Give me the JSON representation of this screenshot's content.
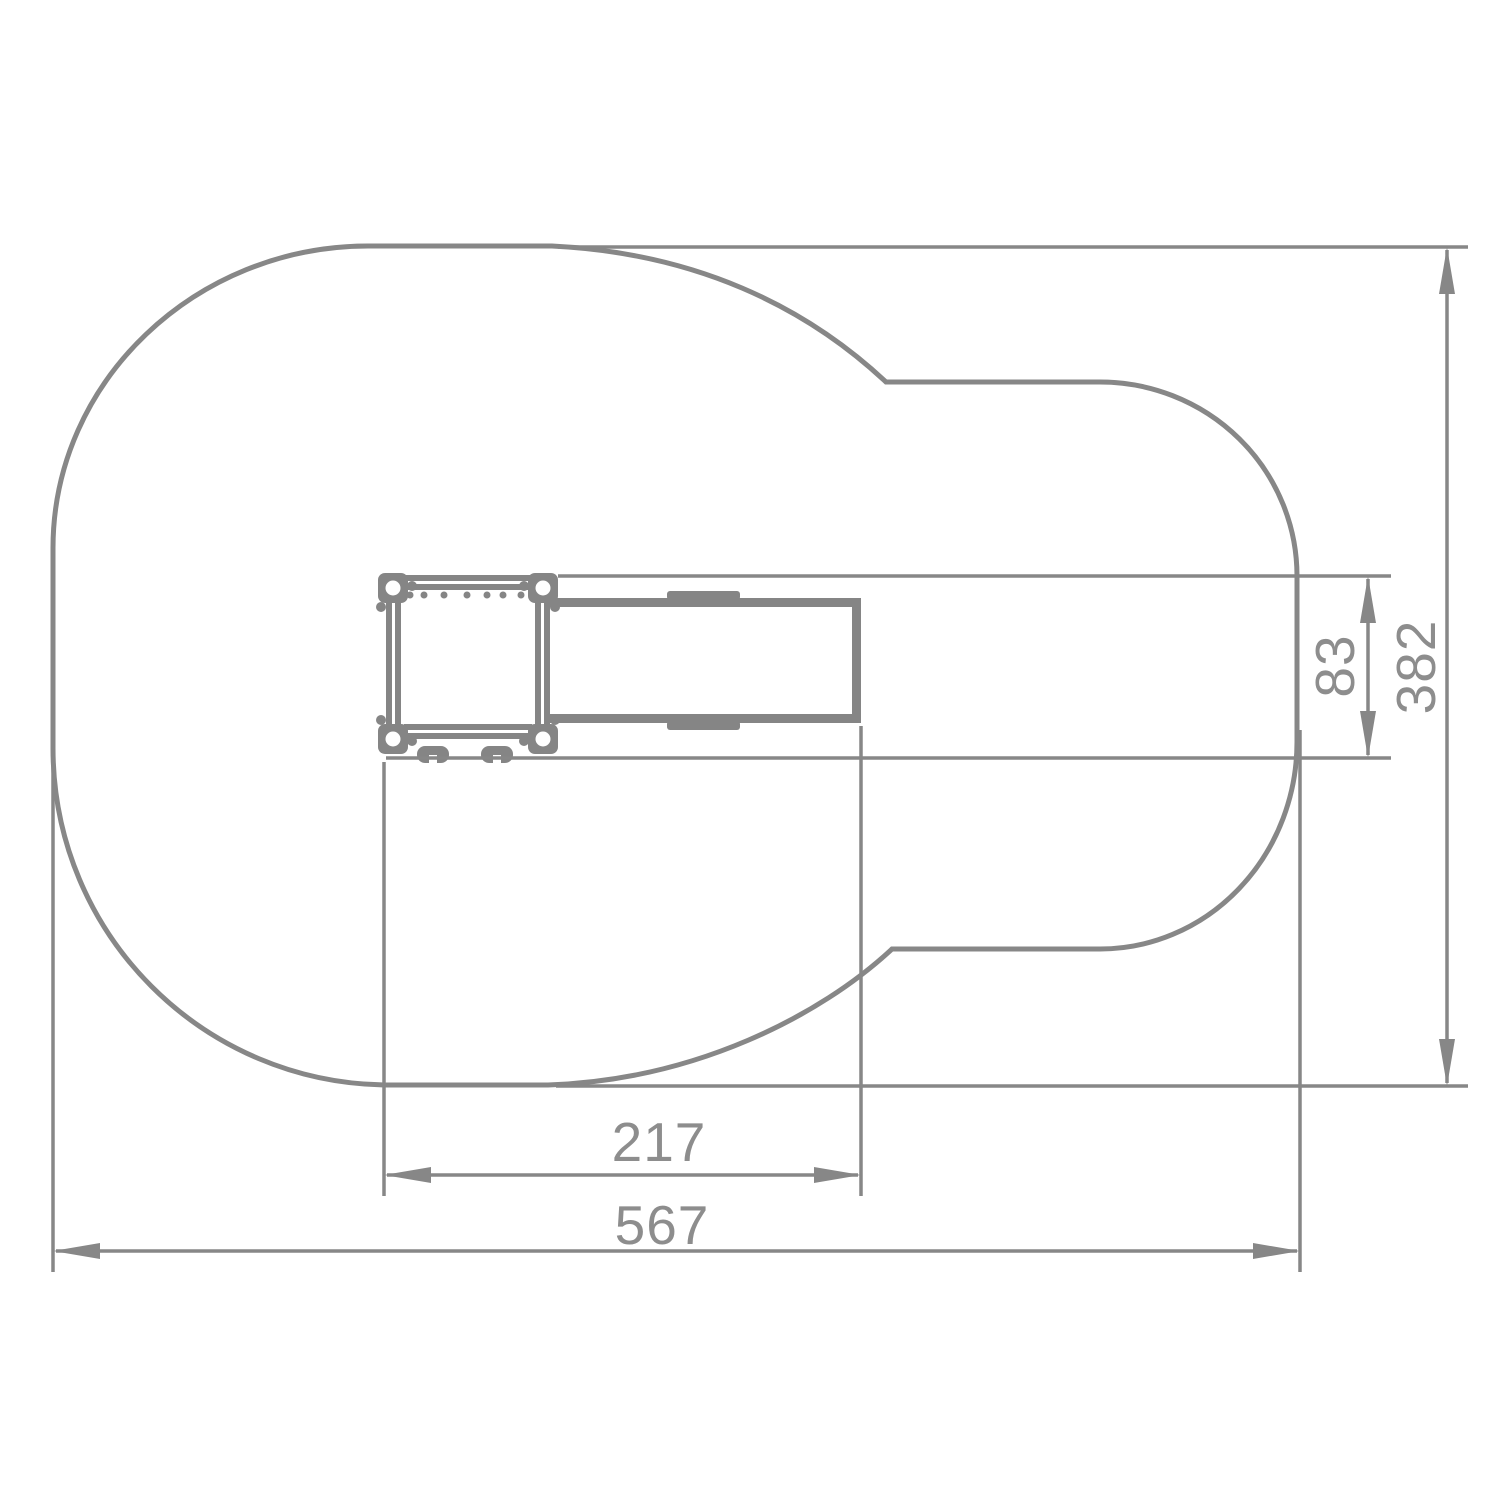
{
  "page": {
    "background": "#ffffff"
  },
  "drawing": {
    "line_color": "#878787",
    "equipment_color": "#858585",
    "text_color": "#8d8d8d",
    "dimensions": {
      "overall_width": {
        "value": "567",
        "orientation": "horizontal"
      },
      "footprint_width": {
        "value": "217",
        "orientation": "horizontal"
      },
      "overall_depth": {
        "value": "382",
        "orientation": "vertical"
      },
      "platform_depth": {
        "value": "83",
        "orientation": "vertical"
      }
    }
  }
}
